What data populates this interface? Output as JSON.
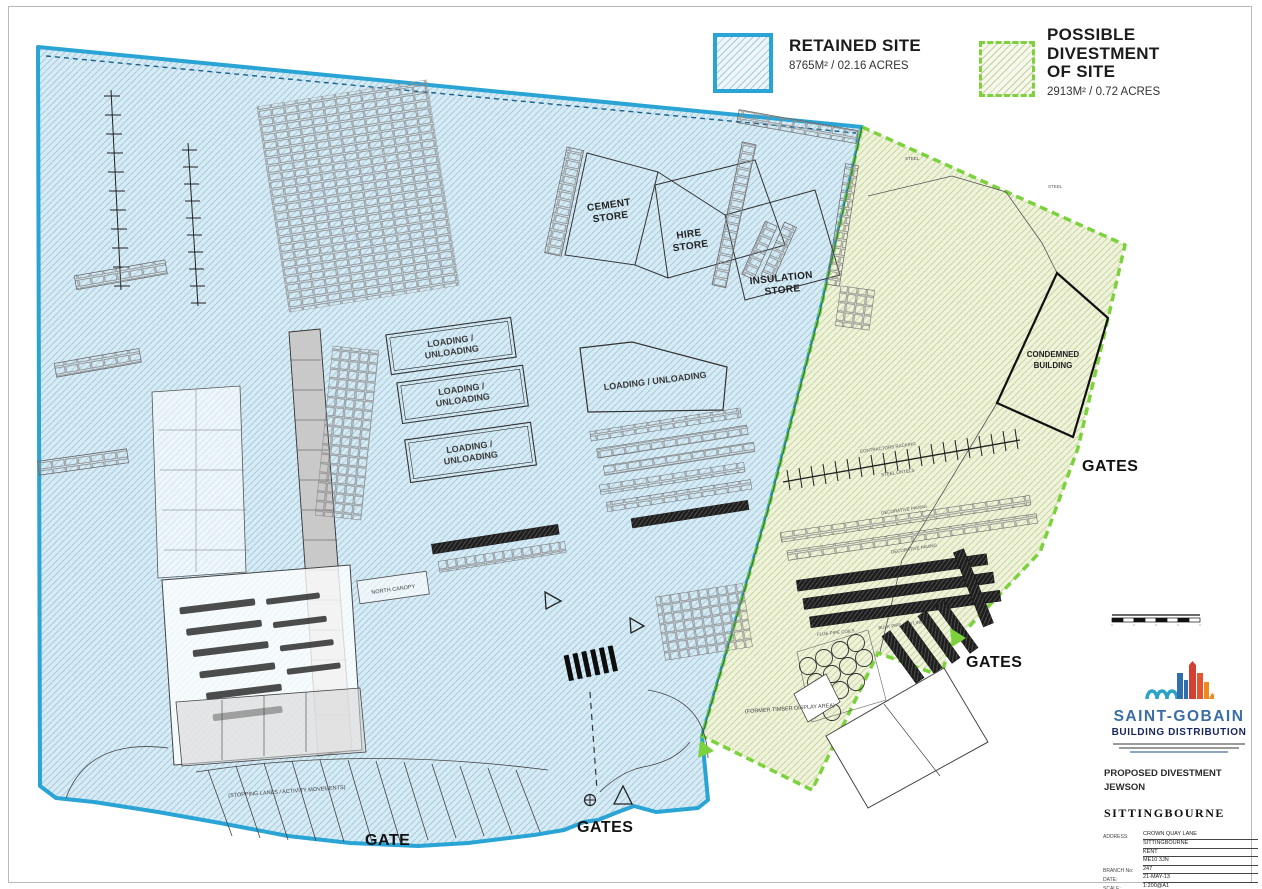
{
  "legend": {
    "retained": {
      "title": "RETAINED SITE",
      "area": "8765M² /  02.16 ACRES"
    },
    "divestment": {
      "title": "POSSIBLE\nDIVESTMENT\nOF SITE",
      "area": "2913M² /  0.72 ACRES"
    }
  },
  "plan_labels": {
    "cement_1": "CEMENT",
    "cement_2": "STORE",
    "hire_1": "HIRE",
    "hire_2": "STORE",
    "insulation_1": "INSULATION",
    "insulation_2": "STORE",
    "loading_1": "LOADING /",
    "loading_2": "UNLOADING",
    "loading_single": "LOADING / UNLOADING",
    "condemned_1": "CONDEMNED",
    "condemned_2": "BUILDING",
    "north_canopy": "NORTH CANOPY",
    "steel": "STEEL",
    "contractors_racking": "CONTRACTORS RACKING",
    "steel_lintels": "STEEL LINTELS",
    "decorative_paving": "DECORATIVE PAVING",
    "bulk_pipe": "BULK PIPE & CYLINDERS",
    "flue_coils": "FLUE PIPE COILS",
    "former_timber": "(FORMER TIMBER DISPLAY AREA)",
    "stopping_lanes": "(STOPPING LANES / ACTIVITY MOVEMENTS)",
    "gates": "GATES",
    "gate": "GATE"
  },
  "title_block": {
    "brand": "SAINT-GOBAIN",
    "division": "BUILDING DISTRIBUTION",
    "project_1": "PROPOSED DIVESTMENT",
    "project_2": "JEWSON",
    "location": "SITTINGBOURNE",
    "rows": [
      {
        "label": "ADDRESS:",
        "value": "CROWN QUAY LANE"
      },
      {
        "label": "",
        "value": "SITTINGBOURNE"
      },
      {
        "label": "",
        "value": "KENT"
      },
      {
        "label": "",
        "value": "ME10 3JN"
      },
      {
        "label": "BRANCH No:",
        "value": "247"
      },
      {
        "label": "DATE:",
        "value": "21-MAY-13"
      },
      {
        "label": "SCALE:",
        "value": "1:200@A1"
      },
      {
        "label": "DRAWN BY:",
        "value": "JLB"
      },
      {
        "label": "DRAWING No:",
        "value": "SK-001"
      }
    ]
  },
  "colors": {
    "retained_border": "#2aa4d5",
    "retained_fill": "#d7ebf5",
    "divestment_border": "#7cd23c",
    "divestment_fill": "#eff3da"
  }
}
